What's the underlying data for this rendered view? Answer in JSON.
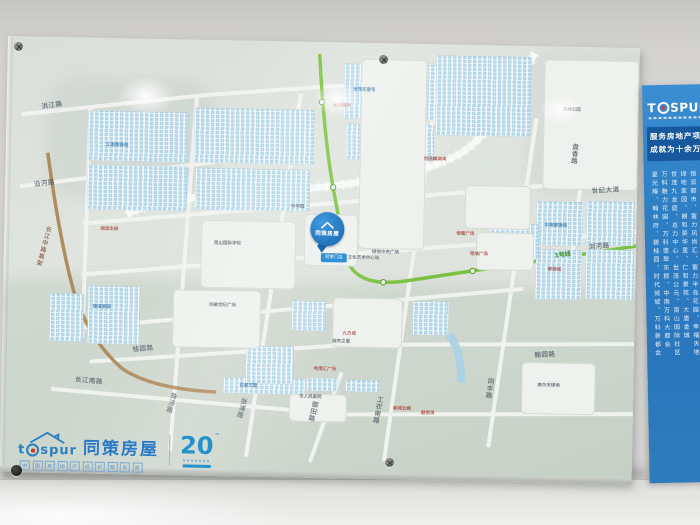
{
  "colors": {
    "sidebar_blue": "#2e7fc4",
    "brand_blue": "#2979c8",
    "metro_green": "#7cc242",
    "highway_brown": "#ab8350",
    "red_label": "#c0392b"
  },
  "marker": {
    "title": "同策房屋",
    "badge": "同策门店"
  },
  "board_logo": {
    "latin_left": "t",
    "latin_right": "spur",
    "cn": "同策房屋",
    "boxed_chars": [
      "中",
      "国",
      "房",
      "地",
      "产",
      "经",
      "纪",
      "服",
      "务",
      "商"
    ],
    "anniversary": "20",
    "anniversary_tm": "™"
  },
  "sidebar": {
    "brand_left": "T",
    "brand_right": "SPUR",
    "slogan_line1": "服务房地产项目超",
    "slogan_line2": "成就为十余万人安",
    "columns": [
      "星光耀、翰林府、碧桂园、时代倾城、万科新都会",
      "万科魅力花园、万科翡翠东郡、中南万科大都会",
      "世茂九龙庭、总力中心、世茂公元、南山国际社区",
      "绿地家园、朗和荣华里、仁和景苑、大唐金城",
      "恒派都市、富力风尚汇、富力半岛花园、幸福天地"
    ]
  },
  "map": {
    "labels": [
      {
        "t": "洪江路",
        "x": 34,
        "y": 64,
        "r": -9,
        "cls": "road"
      },
      {
        "t": "沿河路",
        "x": 28,
        "y": 142,
        "r": -8,
        "cls": "road"
      },
      {
        "t": "长江中路高架",
        "x": 40,
        "y": 188,
        "v": 1,
        "r": 14,
        "cls": "brown"
      },
      {
        "t": "桂园路",
        "x": 130,
        "y": 305,
        "r": -6,
        "cls": "road"
      },
      {
        "t": "长江南路",
        "x": 74,
        "y": 336,
        "r": 4,
        "cls": "road"
      },
      {
        "t": "珠泾路",
        "x": 168,
        "y": 352,
        "v": 1,
        "r": 16,
        "cls": "road"
      },
      {
        "t": "张浦路",
        "x": 238,
        "y": 356,
        "v": 1,
        "r": 14,
        "cls": "road"
      },
      {
        "t": "御田路",
        "x": 309,
        "y": 358,
        "v": 1,
        "r": 12,
        "cls": "road"
      },
      {
        "t": "工农南路",
        "x": 374,
        "y": 352,
        "v": 1,
        "r": 10,
        "cls": "road"
      },
      {
        "t": "同丰路",
        "x": 484,
        "y": 332,
        "v": 1,
        "r": 7,
        "cls": "road"
      },
      {
        "t": "翰园路",
        "x": 532,
        "y": 303,
        "r": -4,
        "cls": "road"
      },
      {
        "t": "世纪大道",
        "x": 586,
        "y": 138,
        "r": -5,
        "cls": "road"
      },
      {
        "t": "盘香路",
        "x": 564,
        "y": 96,
        "v": 1,
        "r": 4,
        "cls": "road"
      },
      {
        "t": "浏河路",
        "x": 584,
        "y": 194,
        "r": -6,
        "cls": "road"
      },
      {
        "t": "1号线",
        "x": 550,
        "y": 204,
        "r": -8,
        "cls": "green"
      },
      {
        "t": "星河国际",
        "x": 326,
        "y": 60,
        "cls": "red"
      },
      {
        "t": "世茂蝶湖湾",
        "x": 418,
        "y": 112,
        "cls": "red"
      },
      {
        "t": "恒隆广场",
        "x": 452,
        "y": 186,
        "cls": "red"
      },
      {
        "t": "昆城广场",
        "x": 466,
        "y": 206,
        "cls": "red"
      },
      {
        "t": "九方城",
        "x": 340,
        "y": 288,
        "cls": "red"
      },
      {
        "t": "电博汇广场",
        "x": 312,
        "y": 324,
        "cls": "red"
      },
      {
        "t": "新城云樾",
        "x": 392,
        "y": 362,
        "cls": "red"
      },
      {
        "t": "碧悦湾",
        "x": 420,
        "y": 366,
        "cls": "red"
      },
      {
        "t": "御锦城",
        "x": 544,
        "y": 220,
        "cls": "red"
      },
      {
        "t": "湖滨华府",
        "x": 96,
        "y": 188,
        "cls": "red"
      },
      {
        "t": "江南明珠苑",
        "x": 100,
        "y": 104,
        "cls": "blue"
      },
      {
        "t": "世茂东壹号",
        "x": 346,
        "y": 44,
        "cls": "blue"
      },
      {
        "t": "中南御锦城",
        "x": 540,
        "y": 176,
        "cls": "blue"
      },
      {
        "t": "花都艺墅",
        "x": 238,
        "y": 342,
        "cls": "blue"
      },
      {
        "t": "锦溪家园",
        "x": 90,
        "y": 266,
        "cls": "blue"
      },
      {
        "t": "昆山国际学校",
        "x": 210,
        "y": 200,
        "cls": "dark"
      },
      {
        "t": "绿地中央广场",
        "x": 368,
        "y": 206,
        "cls": "dark"
      },
      {
        "t": "中华园",
        "x": 286,
        "y": 162,
        "cls": "dark"
      },
      {
        "t": "城市之星",
        "x": 330,
        "y": 296,
        "cls": "dark"
      },
      {
        "t": "市人民医院",
        "x": 298,
        "y": 352,
        "cls": "dark"
      },
      {
        "t": "高尔夫球场",
        "x": 536,
        "y": 336,
        "cls": "dark"
      },
      {
        "t": "森林公园",
        "x": 556,
        "y": 60,
        "cls": "dark"
      },
      {
        "t": "华敏世纪广场",
        "x": 206,
        "y": 262,
        "cls": "dark"
      },
      {
        "t": "文化艺术中心站",
        "x": 344,
        "y": 212,
        "cls": "dark"
      }
    ],
    "clusters": [
      [
        82,
        73,
        100,
        50
      ],
      [
        82,
        127,
        100,
        45
      ],
      [
        188,
        68,
        120,
        55
      ],
      [
        190,
        128,
        115,
        42
      ],
      [
        337,
        21,
        95,
        55
      ],
      [
        340,
        81,
        88,
        36
      ],
      [
        429,
        11,
        95,
        80
      ],
      [
        532,
        155,
        46,
        44
      ],
      [
        582,
        154,
        48,
        44
      ],
      [
        532,
        203,
        46,
        50
      ],
      [
        582,
        202,
        48,
        50
      ],
      [
        85,
        248,
        52,
        58
      ],
      [
        47,
        256,
        34,
        48
      ],
      [
        222,
        337,
        82,
        16
      ],
      [
        305,
        336,
        32,
        13
      ],
      [
        344,
        337,
        34,
        12
      ],
      [
        289,
        259,
        34,
        30
      ],
      [
        244,
        305,
        48,
        38
      ],
      [
        485,
        178,
        50,
        35
      ],
      [
        410,
        257,
        36,
        34
      ]
    ],
    "plots": [
      [
        197,
        180,
        95,
        68
      ],
      [
        170,
        250,
        88,
        58
      ],
      [
        354,
        16,
        66,
        190
      ],
      [
        460,
        140,
        66,
        44
      ],
      [
        472,
        187,
        58,
        38
      ],
      [
        520,
        316,
        74,
        52
      ],
      [
        288,
        352,
        58,
        28
      ],
      [
        300,
        172,
        54,
        52
      ],
      [
        330,
        255,
        70,
        50
      ],
      [
        537,
        13,
        95,
        130
      ]
    ]
  }
}
